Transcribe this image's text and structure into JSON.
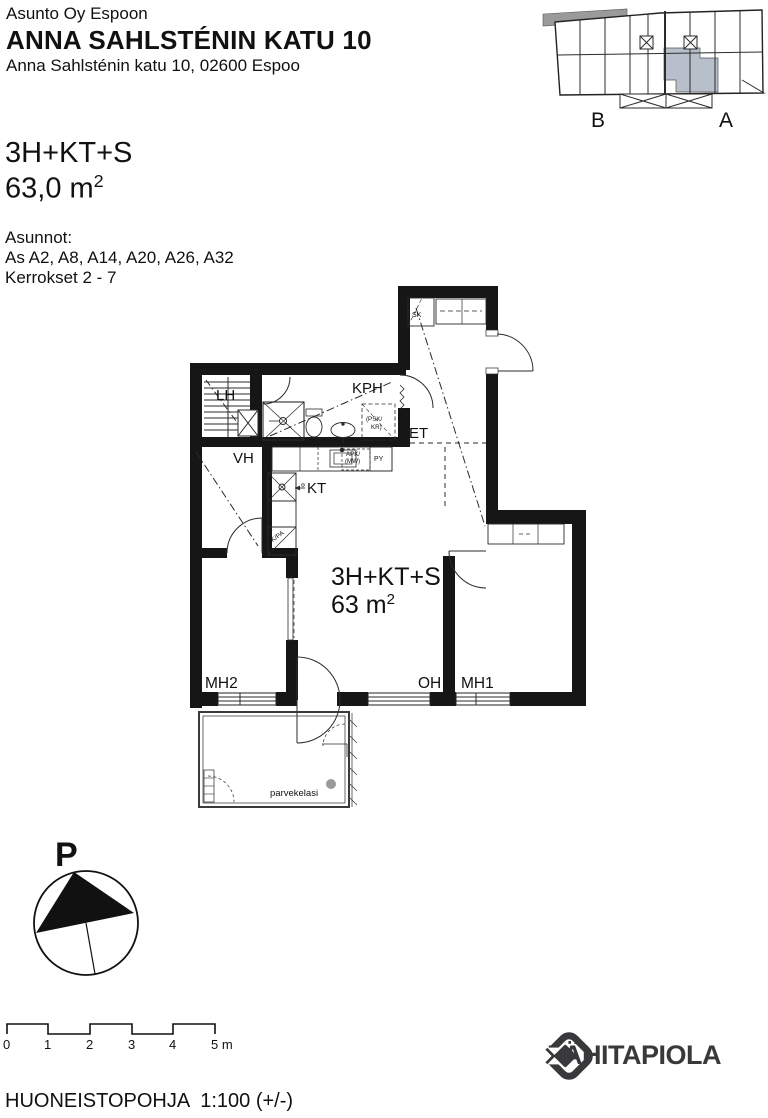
{
  "header": {
    "company": "Asunto Oy Espoon",
    "title": "ANNA SAHLSTÉNIN KATU 10",
    "address": "Anna Sahlsténin katu 10, 02600 Espoo"
  },
  "site_plan": {
    "label_b": "B",
    "label_a": "A",
    "highlight_color": "#b7bfca"
  },
  "apartment": {
    "type": "3H+KT+S",
    "area": "63,0 m",
    "area_sup": "2",
    "units_heading": "Asunnot:",
    "units": "As A2, A8, A14, A20, A26, A32",
    "floors": "Kerrokset 2 - 7"
  },
  "floor_plan": {
    "rooms": {
      "lh": "LH",
      "kph": "KPH",
      "et": "ET",
      "vh": "VH",
      "kt": "KT",
      "sk": "SK",
      "mh2": "MH2",
      "oh": "OH",
      "mh1": "MH1",
      "balcony": "parvekelasi"
    },
    "labels": {
      "type": "3H+KT+S",
      "area": "63 m",
      "area_sup": "2",
      "psk_kr_line1": "(PSK/",
      "psk_kr_line2": "KR)",
      "apk_line1": "APK/",
      "apk_line2": "(MW)",
      "py": "PY",
      "jk_pa": "JK/PA"
    }
  },
  "compass": {
    "north_label": "P"
  },
  "scale_bar": {
    "ticks": [
      "0",
      "1",
      "2",
      "3",
      "4",
      "5 m"
    ]
  },
  "footer": {
    "plan_label": "HUONEISTOPOHJA  1:100 (+/-)",
    "brand": "LÄHITAPIOLA",
    "brand_color": "#39393b"
  }
}
